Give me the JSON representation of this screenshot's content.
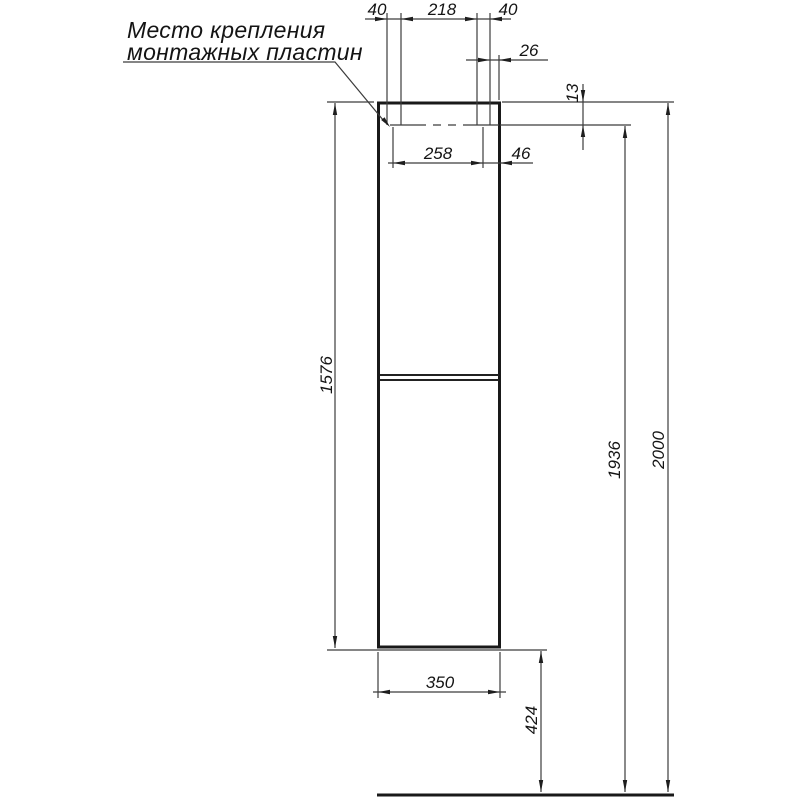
{
  "drawing": {
    "background": "#ffffff",
    "ink": "#1e1e1e",
    "callout": {
      "line1": "Место крепления",
      "line2": "монтажных пластин"
    },
    "dimensions": {
      "plate_left_width": "40",
      "plate_spacing": "218",
      "plate_right_width": "40",
      "plate_edge_offset": "26",
      "top_inset": "13",
      "mount_span": "258",
      "mount_edge_gap": "46",
      "cabinet_height": "1576",
      "mount_line_height": "1936",
      "total_height": "2000",
      "cabinet_width": "350",
      "floor_clearance": "424"
    }
  }
}
